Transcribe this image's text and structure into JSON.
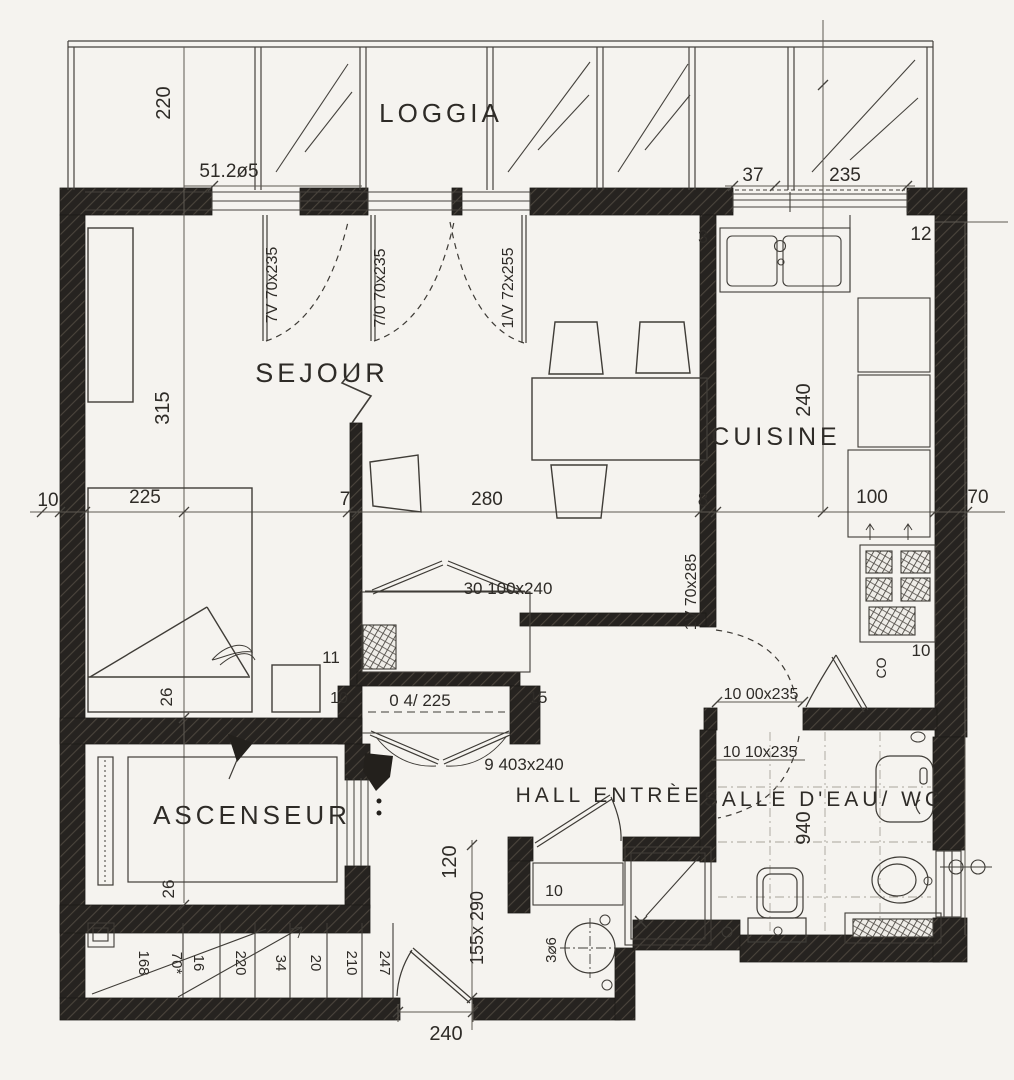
{
  "meta": {
    "drawing_type": "apartment floor plan (scanned)"
  },
  "rooms": {
    "loggia": "LOGGIA",
    "sejour": "SEJOUR",
    "cuisine": "CUISINE",
    "ascenseur": "ASCENSEUR",
    "hall": "HALL ENTRÈE",
    "bath": "SALLE D'EAU/ WC"
  },
  "main_dims": [
    "10",
    "225",
    "7",
    "280",
    "8",
    "100",
    "70"
  ],
  "dims": {
    "loggia_depth": "220",
    "area_note": "51.2ø5",
    "kw_a": "37",
    "kw_b": "235",
    "sejour_h": "315",
    "kitchen_h": "240",
    "bath_h": "940",
    "hall_h": "120",
    "vestibule": "155x 290",
    "entry_w": "240",
    "bed_note": "26",
    "lift_note": "26",
    "n3": "3",
    "n12": "12",
    "n11": "11",
    "n15": "15",
    "n10_closet": "10",
    "n10_vest": "10",
    "n10_kitchen": "10",
    "column": "3⌀6",
    "heater": "CO"
  },
  "openings": {
    "door_a": "7V 70x235",
    "door_b": "7/0 70x235",
    "window_a": "1/V 72x255",
    "door_kitchen": "1V 70x285",
    "closet_top": "30 100x240",
    "closet_note": "0 4/ 225",
    "door_hall": "9 403x240",
    "pass_a": "10 00x235",
    "pass_b": "10 10x235"
  },
  "stairs": [
    "168",
    "70*",
    "16",
    "220",
    "34",
    "20",
    "210",
    "247"
  ]
}
